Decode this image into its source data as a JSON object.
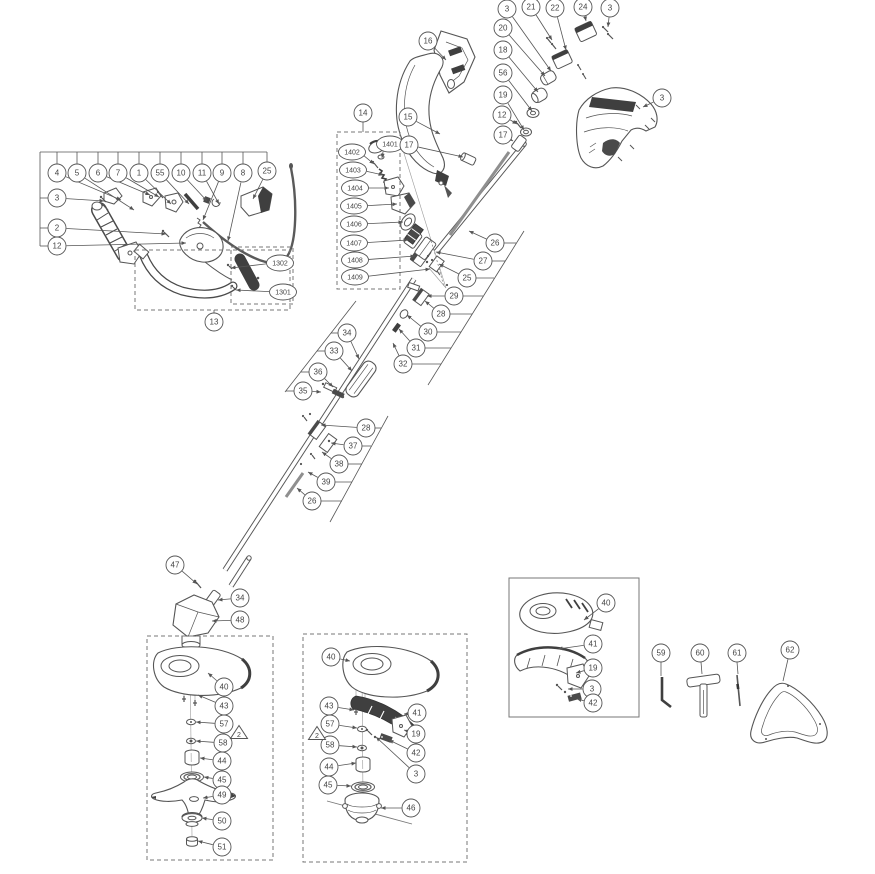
{
  "diagram": {
    "name": "string-trimmer-exploded-parts-diagram",
    "colors": {
      "line": "#555555",
      "dark": "#3f3f3f",
      "gray": "#8f8f8f",
      "text": "#444444",
      "background": "#ffffff",
      "box_border": "#777777"
    },
    "callout_style": {
      "circle_r": 9,
      "ellipse_rx": 13.5,
      "ellipse_ry": 8,
      "font_small": 8,
      "font_tiny": 7
    },
    "callouts": [
      {
        "l": "3",
        "x": 507,
        "y": 9,
        "t": [
          [
            551,
            71
          ]
        ]
      },
      {
        "l": "21",
        "x": 531,
        "y": 7,
        "t": [
          [
            552,
            40
          ]
        ]
      },
      {
        "l": "22",
        "x": 555,
        "y": 8,
        "t": [
          [
            566,
            50
          ]
        ]
      },
      {
        "l": "24",
        "x": 583,
        "y": 7,
        "t": [
          [
            586,
            21
          ]
        ]
      },
      {
        "l": "3",
        "x": 610,
        "y": 8,
        "t": [
          [
            608,
            27
          ]
        ]
      },
      {
        "l": "20",
        "x": 503,
        "y": 28,
        "t": [
          [
            545,
            76
          ]
        ]
      },
      {
        "l": "18",
        "x": 503,
        "y": 50,
        "t": [
          [
            538,
            92
          ]
        ]
      },
      {
        "l": "56",
        "x": 503,
        "y": 73,
        "t": [
          [
            532,
            111
          ]
        ]
      },
      {
        "l": "19",
        "x": 503,
        "y": 95,
        "t": [
          [
            524,
            130
          ]
        ]
      },
      {
        "l": "12",
        "x": 502,
        "y": 115,
        "t": [
          [
            517,
            124
          ]
        ]
      },
      {
        "l": "17",
        "x": 503,
        "y": 135,
        "t": [
          [
            513,
            141
          ]
        ]
      },
      {
        "l": "3",
        "x": 662,
        "y": 98,
        "t": [
          [
            643,
            107
          ]
        ]
      },
      {
        "l": "4",
        "x": 57,
        "y": 173,
        "t": [
          [
            121,
            200
          ]
        ]
      },
      {
        "l": "5",
        "x": 77,
        "y": 173,
        "t": [
          [
            134,
            210
          ]
        ]
      },
      {
        "l": "6",
        "x": 98,
        "y": 173,
        "t": [
          [
            150,
            195
          ]
        ]
      },
      {
        "l": "7",
        "x": 118,
        "y": 173,
        "t": [
          [
            159,
            197
          ]
        ]
      },
      {
        "l": "1",
        "x": 139,
        "y": 173,
        "t": [
          [
            171,
            204
          ]
        ]
      },
      {
        "l": "55",
        "x": 160,
        "y": 173,
        "t": [
          [
            189,
            204
          ]
        ]
      },
      {
        "l": "10",
        "x": 181,
        "y": 173,
        "t": [
          [
            207,
            201
          ]
        ]
      },
      {
        "l": "11",
        "x": 202,
        "y": 173,
        "t": [
          [
            219,
            204
          ]
        ]
      },
      {
        "l": "9",
        "x": 222,
        "y": 173,
        "t": [
          [
            203,
            220
          ]
        ]
      },
      {
        "l": "8",
        "x": 243,
        "y": 173,
        "t": [
          [
            228,
            241
          ]
        ]
      },
      {
        "l": "25",
        "x": 267,
        "y": 171,
        "t": [
          [
            253,
            199
          ]
        ]
      },
      {
        "l": "3",
        "x": 57,
        "y": 198,
        "t": [
          [
            104,
            201
          ]
        ]
      },
      {
        "l": "2",
        "x": 57,
        "y": 228,
        "t": [
          [
            166,
            234
          ]
        ]
      },
      {
        "l": "12",
        "x": 57,
        "y": 246,
        "t": [
          [
            186,
            243
          ]
        ]
      },
      {
        "l": "1302",
        "x": 280,
        "y": 263,
        "s": "e",
        "t": [
          [
            231,
            268
          ]
        ]
      },
      {
        "l": "1301",
        "x": 283,
        "y": 292,
        "s": "e",
        "t": [
          [
            236,
            290
          ]
        ]
      },
      {
        "l": "13",
        "x": 214,
        "y": 322,
        "t": []
      },
      {
        "l": "14",
        "x": 363,
        "y": 113,
        "t": []
      },
      {
        "l": "1401",
        "x": 390,
        "y": 144,
        "s": "e",
        "t": [
          [
            382,
            158
          ]
        ]
      },
      {
        "l": "1402",
        "x": 352,
        "y": 152,
        "s": "e",
        "t": [
          [
            374,
            164
          ]
        ]
      },
      {
        "l": "1403",
        "x": 353,
        "y": 170,
        "s": "e",
        "t": [
          [
            383,
            175
          ]
        ]
      },
      {
        "l": "1404",
        "x": 355,
        "y": 188,
        "s": "e",
        "t": [
          [
            389,
            188
          ]
        ]
      },
      {
        "l": "1405",
        "x": 354,
        "y": 206,
        "s": "e",
        "t": [
          [
            397,
            204
          ]
        ]
      },
      {
        "l": "1406",
        "x": 354,
        "y": 224,
        "s": "e",
        "t": [
          [
            403,
            222
          ]
        ]
      },
      {
        "l": "1407",
        "x": 354,
        "y": 243,
        "s": "e",
        "t": [
          [
            408,
            240
          ]
        ]
      },
      {
        "l": "1408",
        "x": 355,
        "y": 260,
        "s": "e",
        "t": [
          [
            415,
            256
          ]
        ]
      },
      {
        "l": "1409",
        "x": 355,
        "y": 277,
        "s": "e",
        "t": [
          [
            430,
            269
          ]
        ]
      },
      {
        "l": "17",
        "x": 409,
        "y": 145,
        "t": [
          [
            463,
            157
          ]
        ]
      },
      {
        "l": "16",
        "x": 428,
        "y": 41,
        "t": [
          [
            446,
            60
          ]
        ]
      },
      {
        "l": "15",
        "x": 408,
        "y": 117,
        "t": [
          [
            440,
            134
          ]
        ]
      },
      {
        "l": "26",
        "x": 495,
        "y": 243,
        "t": [
          [
            469,
            231
          ]
        ]
      },
      {
        "l": "27",
        "x": 483,
        "y": 261,
        "t": [
          [
            436,
            252
          ]
        ]
      },
      {
        "l": "25",
        "x": 467,
        "y": 278,
        "t": [
          [
            439,
            264
          ]
        ]
      },
      {
        "l": "29",
        "x": 454,
        "y": 296,
        "t": [
          [
            427,
            296
          ]
        ]
      },
      {
        "l": "28",
        "x": 441,
        "y": 314,
        "t": [
          [
            425,
            301
          ]
        ]
      },
      {
        "l": "30",
        "x": 428,
        "y": 332,
        "t": [
          [
            407,
            315
          ]
        ]
      },
      {
        "l": "31",
        "x": 416,
        "y": 348,
        "t": [
          [
            399,
            329
          ]
        ]
      },
      {
        "l": "32",
        "x": 403,
        "y": 364,
        "t": [
          [
            393,
            343
          ]
        ]
      },
      {
        "l": "34",
        "x": 347,
        "y": 333,
        "t": [
          [
            359,
            359
          ]
        ]
      },
      {
        "l": "33",
        "x": 334,
        "y": 351,
        "t": [
          [
            352,
            371
          ]
        ]
      },
      {
        "l": "36",
        "x": 318,
        "y": 372,
        "t": [
          [
            333,
            387
          ]
        ]
      },
      {
        "l": "35",
        "x": 303,
        "y": 391,
        "t": [
          [
            321,
            392
          ]
        ]
      },
      {
        "l": "28",
        "x": 366,
        "y": 428,
        "t": [
          [
            321,
            425
          ]
        ]
      },
      {
        "l": "37",
        "x": 353,
        "y": 446,
        "t": [
          [
            331,
            443
          ]
        ]
      },
      {
        "l": "38",
        "x": 339,
        "y": 464,
        "t": [
          [
            322,
            452
          ]
        ]
      },
      {
        "l": "39",
        "x": 326,
        "y": 482,
        "t": [
          [
            308,
            472
          ]
        ]
      },
      {
        "l": "26",
        "x": 312,
        "y": 501,
        "t": [
          [
            297,
            488
          ]
        ]
      },
      {
        "l": "47",
        "x": 175,
        "y": 565,
        "t": [
          [
            197,
            584
          ]
        ]
      },
      {
        "l": "34",
        "x": 240,
        "y": 598,
        "t": [
          [
            218,
            600
          ]
        ]
      },
      {
        "l": "48",
        "x": 240,
        "y": 620,
        "t": [
          [
            212,
            621
          ]
        ]
      },
      {
        "l": "40",
        "x": 224,
        "y": 687,
        "t": [
          [
            208,
            673
          ]
        ]
      },
      {
        "l": "43",
        "x": 224,
        "y": 706,
        "t": [
          [
            198,
            695
          ]
        ]
      },
      {
        "l": "57",
        "x": 224,
        "y": 724,
        "t": [
          [
            196,
            722
          ]
        ]
      },
      {
        "l": "58",
        "x": 223,
        "y": 743,
        "t": [
          [
            196,
            741
          ]
        ]
      },
      {
        "l": "44",
        "x": 222,
        "y": 761,
        "t": [
          [
            200,
            758
          ]
        ]
      },
      {
        "l": "45",
        "x": 222,
        "y": 780,
        "t": [
          [
            204,
            777
          ]
        ]
      },
      {
        "l": "49",
        "x": 222,
        "y": 795,
        "t": [
          [
            203,
            798
          ]
        ]
      },
      {
        "l": "50",
        "x": 222,
        "y": 821,
        "t": [
          [
            202,
            818
          ]
        ]
      },
      {
        "l": "51",
        "x": 222,
        "y": 847,
        "t": [
          [
            198,
            841
          ]
        ]
      },
      {
        "l": "40",
        "x": 331,
        "y": 657,
        "t": [
          [
            350,
            661
          ]
        ]
      },
      {
        "l": "43",
        "x": 329,
        "y": 706,
        "t": [
          [
            354,
            710
          ]
        ]
      },
      {
        "l": "57",
        "x": 330,
        "y": 724,
        "t": [
          [
            357,
            728
          ]
        ]
      },
      {
        "l": "58",
        "x": 330,
        "y": 745,
        "t": [
          [
            357,
            747
          ]
        ]
      },
      {
        "l": "44",
        "x": 329,
        "y": 767,
        "t": [
          [
            356,
            763
          ]
        ]
      },
      {
        "l": "45",
        "x": 328,
        "y": 785,
        "t": [
          [
            351,
            786
          ]
        ]
      },
      {
        "l": "41",
        "x": 417,
        "y": 713,
        "t": [
          [
            404,
            714
          ]
        ]
      },
      {
        "l": "19",
        "x": 416,
        "y": 734,
        "t": [
          [
            404,
            730
          ]
        ]
      },
      {
        "l": "42",
        "x": 416,
        "y": 753,
        "t": [
          [
            389,
            740
          ]
        ]
      },
      {
        "l": "3",
        "x": 416,
        "y": 774,
        "t": [
          [
            376,
            737
          ]
        ]
      },
      {
        "l": "46",
        "x": 411,
        "y": 808,
        "t": [
          [
            381,
            808
          ]
        ]
      },
      {
        "l": "40",
        "x": 606,
        "y": 603,
        "t": [
          [
            584,
            620
          ]
        ]
      },
      {
        "l": "41",
        "x": 593,
        "y": 644,
        "t": [
          [
            558,
            649
          ]
        ]
      },
      {
        "l": "19",
        "x": 593,
        "y": 668,
        "t": [
          [
            576,
            673
          ]
        ]
      },
      {
        "l": "3",
        "x": 592,
        "y": 689,
        "t": [
          [
            568,
            689
          ]
        ]
      },
      {
        "l": "42",
        "x": 593,
        "y": 703,
        "t": [
          [
            577,
            699
          ]
        ]
      },
      {
        "l": "59",
        "x": 661,
        "y": 653,
        "t": []
      },
      {
        "l": "60",
        "x": 700,
        "y": 653,
        "t": []
      },
      {
        "l": "61",
        "x": 737,
        "y": 653,
        "t": []
      },
      {
        "l": "62",
        "x": 790,
        "y": 650,
        "t": []
      }
    ],
    "warning_triangles": [
      {
        "l": "2",
        "x": 239,
        "y": 733
      },
      {
        "l": "2",
        "x": 317,
        "y": 734
      }
    ],
    "boxes": [
      {
        "x": 135,
        "y": 250,
        "w": 155,
        "h": 60,
        "style": "dashed"
      },
      {
        "x": 231,
        "y": 247,
        "w": 62,
        "h": 57,
        "style": "dashed"
      },
      {
        "x": 337,
        "y": 132,
        "w": 63,
        "h": 157,
        "style": "dashed"
      },
      {
        "x": 147,
        "y": 636,
        "w": 126,
        "h": 224,
        "style": "dashed"
      },
      {
        "x": 303,
        "y": 634,
        "w": 164,
        "h": 228,
        "style": "dashed"
      },
      {
        "x": 509,
        "y": 578,
        "w": 130,
        "h": 139,
        "style": "solid"
      }
    ],
    "connector_lines": [
      [
        40,
        152,
        267,
        152
      ],
      [
        40,
        152,
        40,
        246
      ],
      [
        57,
        152,
        57,
        164
      ],
      [
        77,
        152,
        77,
        164
      ],
      [
        98,
        152,
        98,
        164
      ],
      [
        118,
        152,
        118,
        164
      ],
      [
        139,
        152,
        139,
        164
      ],
      [
        160,
        152,
        160,
        164
      ],
      [
        181,
        152,
        181,
        164
      ],
      [
        202,
        152,
        202,
        164
      ],
      [
        222,
        152,
        222,
        164
      ],
      [
        243,
        152,
        243,
        164
      ],
      [
        267,
        152,
        267,
        162
      ],
      [
        40,
        198,
        48,
        198
      ],
      [
        40,
        228,
        48,
        228
      ],
      [
        40,
        246,
        48,
        246
      ],
      [
        524,
        231,
        428,
        385
      ],
      [
        504,
        243,
        516,
        243
      ],
      [
        492,
        261,
        505,
        261
      ],
      [
        476,
        278,
        494,
        278
      ],
      [
        463,
        296,
        483,
        296
      ],
      [
        450,
        314,
        472,
        314
      ],
      [
        437,
        332,
        461,
        332
      ],
      [
        425,
        348,
        451,
        348
      ],
      [
        412,
        364,
        441,
        364
      ],
      [
        388,
        416,
        330,
        522
      ],
      [
        375,
        428,
        381,
        428
      ],
      [
        362,
        446,
        371,
        446
      ],
      [
        348,
        464,
        362,
        464
      ],
      [
        335,
        482,
        352,
        482
      ],
      [
        321,
        501,
        342,
        501
      ],
      [
        356,
        301,
        285,
        392
      ],
      [
        338,
        333,
        331,
        333
      ],
      [
        325,
        351,
        317,
        351
      ],
      [
        309,
        372,
        301,
        372
      ],
      [
        294,
        391,
        286,
        391
      ],
      [
        661,
        662,
        661,
        676
      ],
      [
        701,
        662,
        702,
        674
      ],
      [
        737,
        662,
        738,
        674
      ],
      [
        788,
        659,
        783,
        681
      ],
      [
        214,
        313,
        214,
        310
      ],
      [
        363,
        122,
        363,
        132
      ]
    ]
  }
}
